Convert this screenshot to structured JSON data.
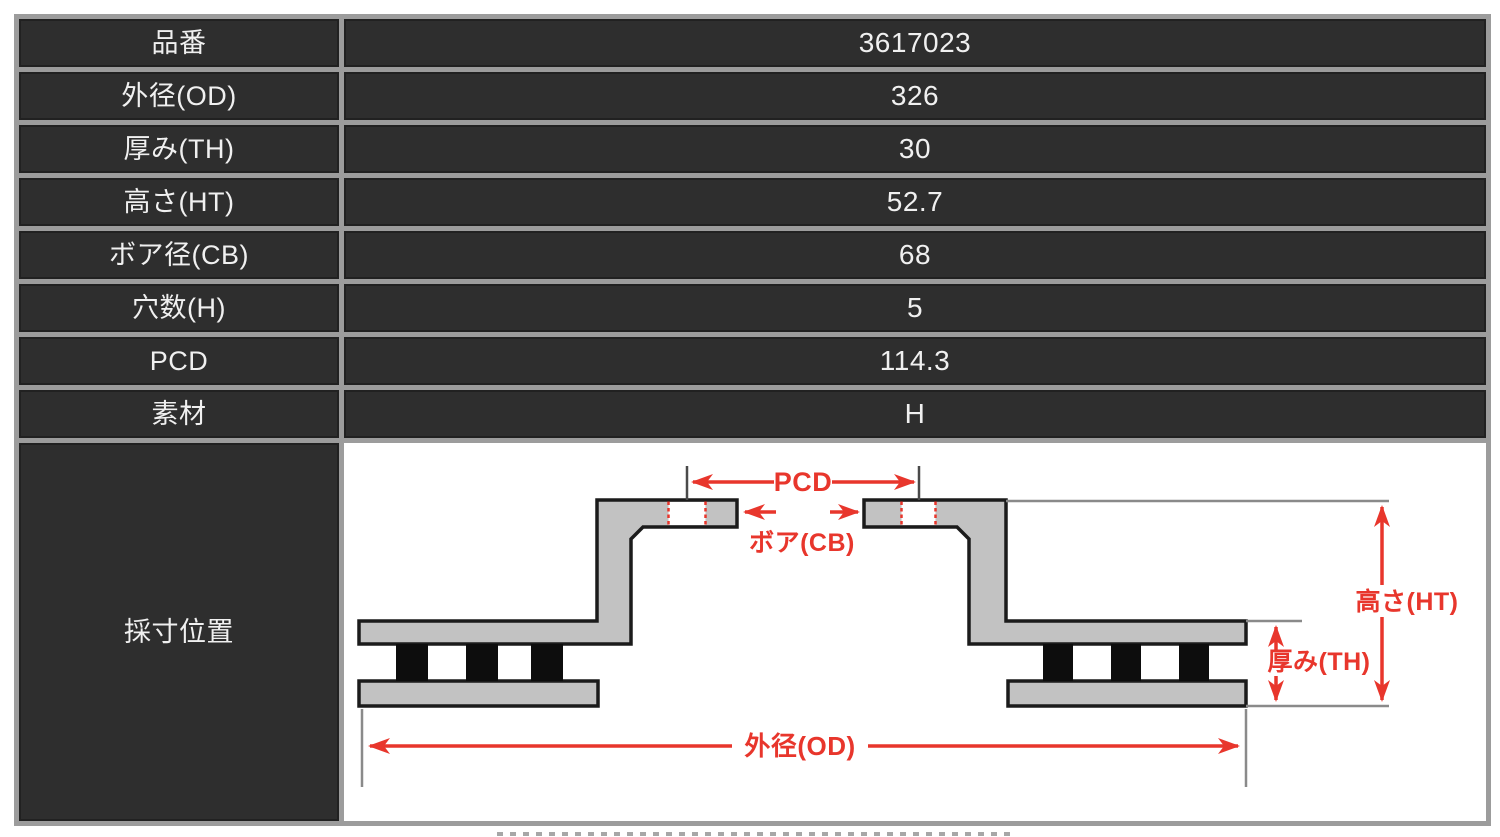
{
  "spec_table": {
    "rows": [
      {
        "label": "品番",
        "value": "3617023"
      },
      {
        "label": "外径(OD)",
        "value": "326"
      },
      {
        "label": "厚み(TH)",
        "value": "30"
      },
      {
        "label": "高さ(HT)",
        "value": "52.7"
      },
      {
        "label": "ボア径(CB)",
        "value": "68"
      },
      {
        "label": "穴数(H)",
        "value": "5"
      },
      {
        "label": "PCD",
        "value": "114.3"
      },
      {
        "label": "素材",
        "value": "H"
      }
    ],
    "diagram_row": {
      "label": "採寸位置"
    }
  },
  "diagram": {
    "dimension_labels": {
      "pcd": "PCD",
      "bore": "ボア(CB)",
      "height": "高さ(HT)",
      "thickness": "厚み(TH)",
      "outer_diameter": "外径(OD)"
    },
    "colors": {
      "dimension_red": "#e8362c",
      "rotor_fill": "#c2c2c2",
      "rotor_outline": "#1b1b1b",
      "vent_fill": "#0d0d0d",
      "extension_line_gray": "#8a8a8a",
      "cell_background": "#2e2e2e",
      "cell_text": "#f0f0f0",
      "table_border_gray": "#9c9c9c",
      "page_background": "#ffffff"
    }
  }
}
